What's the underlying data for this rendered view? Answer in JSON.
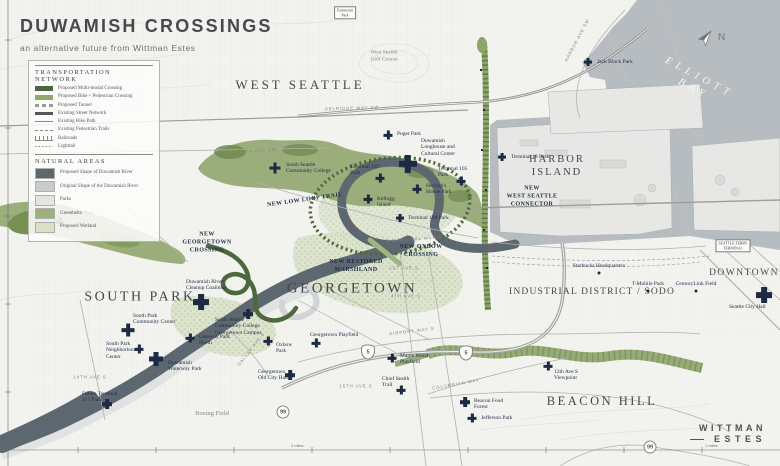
{
  "title": {
    "main": "DUWAMISH CROSSINGS",
    "subtitle": "an alternative future from Wittman Estes"
  },
  "legend": {
    "transportation": {
      "heading": "TRANSPORTATION NETWORK",
      "items": [
        {
          "label": "Proposed Multi-modal Crossing",
          "style": "bar",
          "color": "#4a6340"
        },
        {
          "label": "Proposed Bike + Pedestrian Crossing",
          "style": "bar",
          "color": "#8fa96d"
        },
        {
          "label": "Proposed Tunnel",
          "style": "dashed-bar",
          "color": "#9a9a96"
        },
        {
          "label": "Existing Street Network",
          "style": "bar-thin",
          "color": "#55585a"
        },
        {
          "label": "Existing Bike Path",
          "style": "line",
          "color": "#8a8a86"
        },
        {
          "label": "Existing Pedestrian Trails",
          "style": "line-dashed",
          "color": "#8a8a86"
        },
        {
          "label": "Railroads",
          "style": "line-rail",
          "color": "#8a8a86"
        },
        {
          "label": "Lightrail",
          "style": "line-dotted",
          "color": "#8a8a86"
        }
      ]
    },
    "natural": {
      "heading": "NATURAL AREAS",
      "items": [
        {
          "label": "Proposed Shape of Duwamish River",
          "style": "area",
          "color": "#5d6770"
        },
        {
          "label": "Original Shape of the Duwamish River",
          "style": "area",
          "color": "#c8cbcd"
        },
        {
          "label": "Parks",
          "style": "area",
          "color": "#e3e5e2"
        },
        {
          "label": "Greenbelts",
          "style": "area",
          "color": "#9cb07c"
        },
        {
          "label": "Proposed Wetland",
          "style": "area",
          "color": "#d8e0c7"
        }
      ]
    }
  },
  "compass": {
    "north_label": "N"
  },
  "logo": {
    "line1": "WITTMAN",
    "line2": "ESTES"
  },
  "palette": {
    "water": "#b7bcc0",
    "land": "#f2f2ef",
    "greenbelt": "#9aad7b",
    "wetland": "#dae2ca",
    "proposed_river": "#5d6770",
    "marker_navy": "#1c2a43"
  },
  "regions": [
    {
      "name": "WEST SEATTLE",
      "x": 300,
      "y": 85,
      "size": 13,
      "ls": 3
    },
    {
      "name": "HARBOR\nISLAND",
      "x": 557,
      "y": 166,
      "size": 10.5,
      "ls": 2
    },
    {
      "name": "SOUTH PARK",
      "x": 140,
      "y": 297,
      "size": 14,
      "ls": 2.5
    },
    {
      "name": "GEORGETOWN",
      "x": 352,
      "y": 289,
      "size": 15,
      "ls": 2.5
    },
    {
      "name": "INDUSTRIAL DISTRICT / SODO",
      "x": 592,
      "y": 293,
      "size": 9.5,
      "ls": 1.2
    },
    {
      "name": "DOWNTOWN",
      "x": 744,
      "y": 274,
      "size": 9.5,
      "ls": 1.5
    },
    {
      "name": "BEACON HILL",
      "x": 602,
      "y": 402,
      "size": 12.5,
      "ls": 2.5
    }
  ],
  "water_label": {
    "name": "ELLIOTT BAY",
    "x": 696,
    "y": 84,
    "size": 10.5,
    "ls": 5,
    "rotate": 28
  },
  "new_infrastructure_labels": [
    {
      "text": "NEW LOW LOOP TRAIL",
      "x": 305,
      "y": 201,
      "rotate": -8
    },
    {
      "text": "NEW OXBOW\nCROSSING",
      "x": 421,
      "y": 252,
      "rotate": 0
    },
    {
      "text": "NEW RESTORED\nMARSHLAND",
      "x": 356,
      "y": 267,
      "rotate": 0
    },
    {
      "text": "NEW\nGEORGETOWN\nCROSSING",
      "x": 207,
      "y": 243,
      "rotate": 0
    },
    {
      "text": "NEW\nWEST SEATTLE\nCONNECTOR",
      "x": 532,
      "y": 197,
      "rotate": 0
    }
  ],
  "parks_pois": [
    {
      "name": "Jack Block Park",
      "x": 588,
      "y": 62,
      "size": 8,
      "lx": 597,
      "ly": 59
    },
    {
      "name": "Puget Park",
      "x": 388,
      "y": 135,
      "size": 9,
      "lx": 397,
      "ly": 131
    },
    {
      "name": "Duwamish\nLonghouse and\nCultural Center",
      "x": 408,
      "y": 164,
      "size": 18,
      "lx": 421,
      "ly": 138
    },
    {
      "name": "South Seattle\nCommunity College",
      "x": 275,
      "y": 168,
      "size": 11,
      "lx": 286,
      "ly": 162
    },
    {
      "name": "Terminal 107\nPark",
      "x": 380,
      "y": 178,
      "size": 9,
      "lx": 350,
      "ly": 164
    },
    {
      "name": "Terminal 105\nPark",
      "x": 461,
      "y": 181,
      "size": 9,
      "lx": 438,
      "ly": 166
    },
    {
      "name": "Herring's\nHouse Park",
      "x": 417,
      "y": 189,
      "size": 9,
      "lx": 426,
      "ly": 183
    },
    {
      "name": "Kellogg\nIsland",
      "x": 368,
      "y": 199,
      "size": 9,
      "lx": 377,
      "ly": 196
    },
    {
      "name": "Terminal 108 Park",
      "x": 400,
      "y": 218,
      "size": 8,
      "lx": 408,
      "ly": 215
    },
    {
      "name": "Terminal 18 Park",
      "x": 502,
      "y": 157,
      "size": 8,
      "lx": 511,
      "ly": 154
    },
    {
      "name": "Westcrest Park",
      "x": 60,
      "y": 222,
      "size": 9,
      "lx": 62,
      "ly": 210
    },
    {
      "name": "Duwamish River\nCleanup Coalition",
      "x": 201,
      "y": 302,
      "size": 16,
      "lx": 186,
      "ly": 279
    },
    {
      "name": "South Park\nCommunity Center",
      "x": 128,
      "y": 330,
      "size": 13,
      "lx": 133,
      "ly": 313
    },
    {
      "name": "South Seattle\nCommunity College\nGeorgetown Campus",
      "x": 248,
      "y": 314,
      "size": 10,
      "lx": 215,
      "ly": 317
    },
    {
      "name": "Gateway Park\nNorth",
      "x": 190,
      "y": 338,
      "size": 9,
      "lx": 199,
      "ly": 334
    },
    {
      "name": "South Park\nNeighborhood\nCenter",
      "x": 139,
      "y": 349,
      "size": 9,
      "lx": 106,
      "ly": 341
    },
    {
      "name": "Oxbow\nPark",
      "x": 268,
      "y": 341,
      "size": 9,
      "lx": 276,
      "ly": 342
    },
    {
      "name": "Duwamish\nWaterway Park",
      "x": 156,
      "y": 359,
      "size": 14,
      "lx": 168,
      "ly": 360
    },
    {
      "name": "Georgetown\nOld City Hall",
      "x": 290,
      "y": 375,
      "size": 10,
      "lx": 258,
      "ly": 369
    },
    {
      "name": "Future Terminal\n117 Park",
      "x": 107,
      "y": 404,
      "size": 10,
      "lx": 82,
      "ly": 391
    },
    {
      "name": "Georgetown Playfield",
      "x": 316,
      "y": 343,
      "size": 9,
      "lx": 310,
      "ly": 332
    },
    {
      "name": "Maple Wood\nPlayfield",
      "x": 392,
      "y": 358,
      "size": 9,
      "lx": 400,
      "ly": 353
    },
    {
      "name": "Chief Sealth\nTrail",
      "x": 401,
      "y": 390,
      "size": 9,
      "lx": 382,
      "ly": 376
    },
    {
      "name": "12th Ave S\nViewpoint",
      "x": 548,
      "y": 366,
      "size": 9,
      "lx": 554,
      "ly": 369
    },
    {
      "name": "Beacon Food\nForest",
      "x": 465,
      "y": 402,
      "size": 10,
      "lx": 474,
      "ly": 398
    },
    {
      "name": "Jefferson Park",
      "x": 472,
      "y": 418,
      "size": 9,
      "lx": 481,
      "ly": 415
    },
    {
      "name": "Seattle City Hall",
      "x": 764,
      "y": 295,
      "size": 16,
      "lx": 729,
      "ly": 304
    }
  ],
  "dot_pois": [
    {
      "name": "Starbucks Headquarters",
      "x": 599,
      "y": 273
    },
    {
      "name": "T-Mobile Park",
      "x": 648,
      "y": 291
    },
    {
      "name": "CenturyLink Field",
      "x": 696,
      "y": 291
    }
  ],
  "road_labels": [
    {
      "text": "DELRIDGE WAY SW",
      "x": 352,
      "y": 108,
      "rotate": -2
    },
    {
      "text": "35TH AVE SW",
      "x": 258,
      "y": 150,
      "rotate": -2
    },
    {
      "text": "E MARGINAL WAY S",
      "x": 414,
      "y": 239,
      "rotate": -4
    },
    {
      "text": "1ST AVE S",
      "x": 404,
      "y": 268,
      "rotate": 0
    },
    {
      "text": "4TH AVE S",
      "x": 406,
      "y": 296,
      "rotate": 0
    },
    {
      "text": "AIRPORT WAY S",
      "x": 412,
      "y": 331,
      "rotate": -7
    },
    {
      "text": "14TH AVE S",
      "x": 90,
      "y": 377,
      "rotate": 0
    },
    {
      "text": "15TH AVE S",
      "x": 356,
      "y": 386,
      "rotate": 0
    },
    {
      "text": "COLUMBIAN WAY",
      "x": 456,
      "y": 384,
      "rotate": -10
    },
    {
      "text": "DALLAS AVE S",
      "x": 251,
      "y": 349,
      "rotate": -52
    },
    {
      "text": "HARBOR AVE SW",
      "x": 577,
      "y": 40,
      "rotate": -62
    }
  ],
  "highway_shields": [
    {
      "text": "5",
      "x": 368,
      "y": 352,
      "type": "interstate"
    },
    {
      "text": "5",
      "x": 466,
      "y": 353,
      "type": "interstate"
    },
    {
      "text": "99",
      "x": 283,
      "y": 412,
      "type": "state"
    },
    {
      "text": "99",
      "x": 650,
      "y": 447,
      "type": "state"
    }
  ],
  "boxed_labels": [
    {
      "text": "Fairmount\nPark",
      "x": 345,
      "y": 13
    },
    {
      "text": "SEATTLE FERRY\nTERMINAL",
      "x": 733,
      "y": 246
    }
  ],
  "area_labels": [
    {
      "text": "West Seattle\nGolf Course",
      "x": 384,
      "y": 56,
      "size": 5.5
    },
    {
      "text": "Boeing Field",
      "x": 212,
      "y": 414,
      "size": 6.5
    }
  ],
  "scale_labels": [
    {
      "text": "2 miles",
      "x": 291,
      "y": 444
    },
    {
      "text": "1 miles",
      "x": 705,
      "y": 444
    }
  ]
}
